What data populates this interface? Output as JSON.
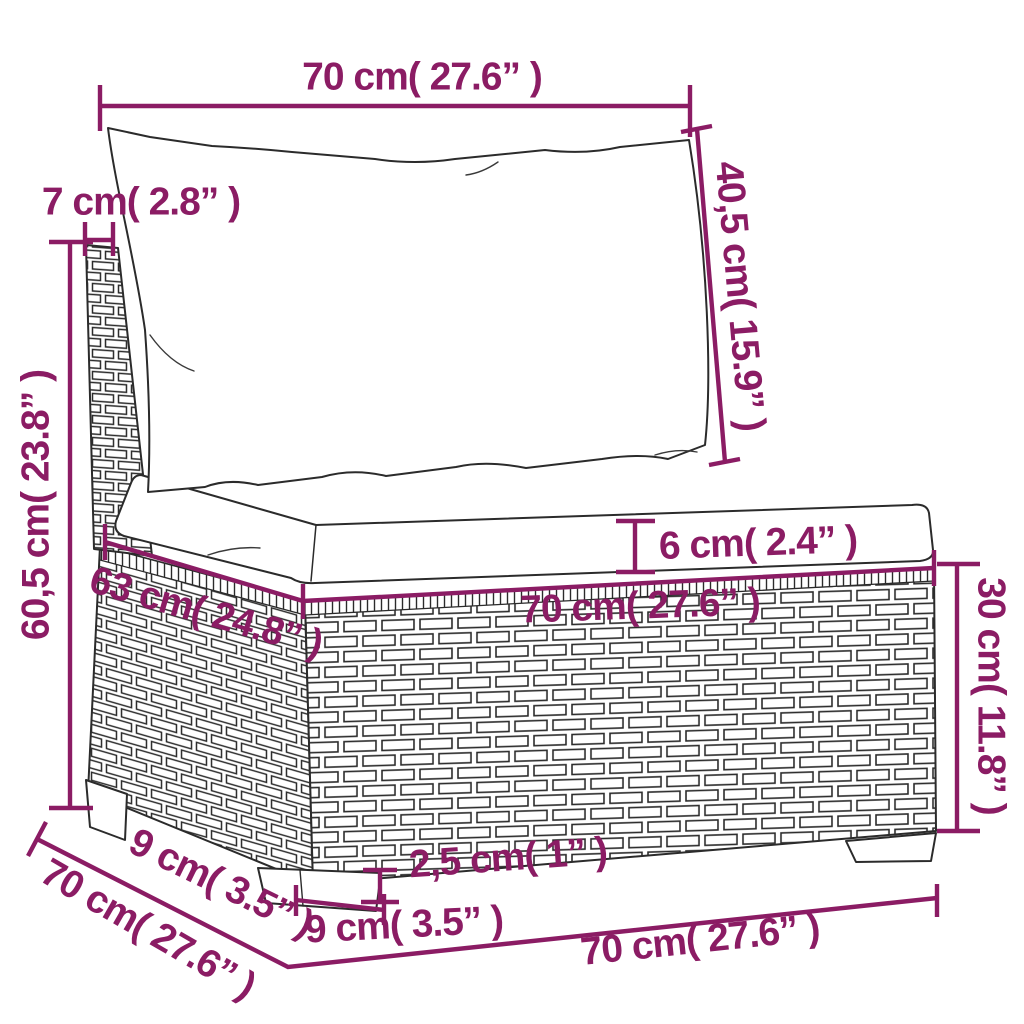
{
  "figure": {
    "kind": "product-dimension-diagram",
    "subject": "poly-rattan garden sofa middle section with back and seat cushions",
    "accent_color": "#8b1c64",
    "outline_color": "#262626",
    "background_color": "#ffffff"
  },
  "dimensions": {
    "back_width_top": "70 cm( 27.6” )",
    "post_width": "7 cm( 2.8” )",
    "back_cushion_height": "40,5 cm( 15.9” )",
    "overall_height": "60,5 cm( 23.8” )",
    "seat_cushion_thickness": "6 cm( 2.4” )",
    "seat_front_width": "70 cm( 27.6” )",
    "seat_side_depth": "63 cm( 24.8” )",
    "base_height": "30 cm( 11.8” )",
    "leg_height": "2,5 cm( 1” )",
    "leg_front_width": "9 cm( 3.5” )",
    "leg_side_inset": "9 cm( 3.5” )",
    "bottom_side_depth": "70 cm( 27.6” )",
    "bottom_front_width": "70 cm( 27.6” )"
  }
}
